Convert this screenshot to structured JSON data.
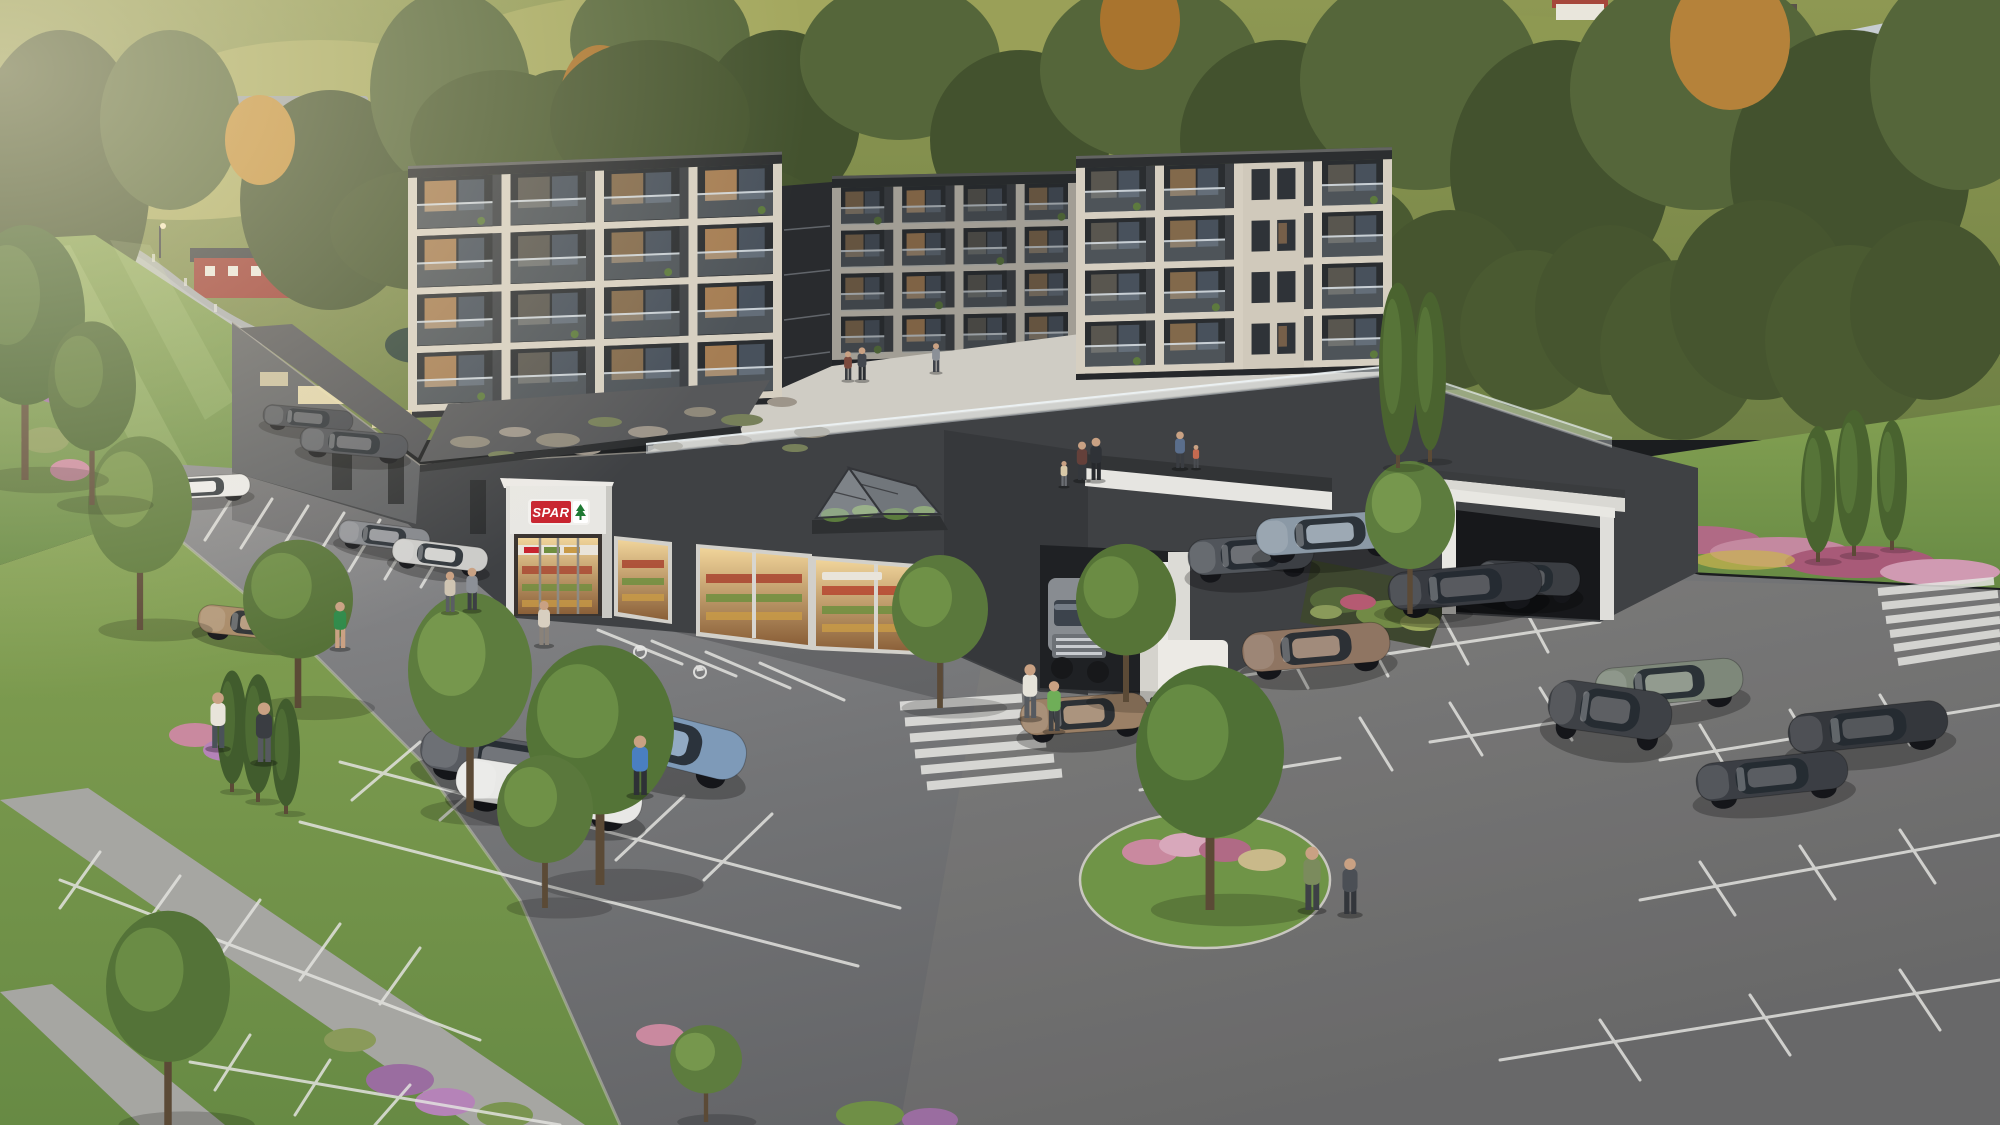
{
  "meta": {
    "title": "Aerial architectural rendering of a dark apartment complex with SPAR supermarket, rooftop courtyard terrace and large parking lot in a hillside village",
    "type": "3d-visualization",
    "width": 2000,
    "height": 1125
  },
  "signs": {
    "store_portal": "SPAR"
  },
  "palette": {
    "facade_dark": "#3d4044",
    "facade_shadow": "#36383b",
    "accent_cream": "#d6cfc1",
    "roof_dark": "#2c2e30",
    "terrace": "#cfccc4",
    "asphalt": "#77787a",
    "parking_line": "#e2e2de",
    "grass": "#6f9447",
    "tree_dark": "#567437",
    "tree_light": "#73984a",
    "autumn": "#b5823a",
    "spar_red": "#c8242f",
    "spar_green": "#1f7a34",
    "glass": "#8a97a6",
    "truck_white": "#e8e8e5"
  },
  "scene": {
    "wings": [
      {
        "id": "apartment-left-wing",
        "layer": "front",
        "x": 408,
        "y": 166,
        "w": 374,
        "h": 252,
        "floors": 4,
        "bays": 4,
        "skew": -2.2,
        "solid": [],
        "dim": 0,
        "seed": 0
      },
      {
        "id": "apartment-rear-wing",
        "layer": "rear",
        "x": 832,
        "y": 176,
        "w": 245,
        "h": 190,
        "floors": 4,
        "bays": 4,
        "skew": -1.2,
        "solid": [],
        "dim": 0.28,
        "seed": 1
      },
      {
        "id": "apartment-right-wing",
        "layer": "front",
        "x": 1076,
        "y": 156,
        "w": 316,
        "h": 224,
        "floors": 4,
        "bays": 4,
        "skew": -1.6,
        "solid": [
          2
        ],
        "dim": 0,
        "seed": 2
      }
    ],
    "gravel_patches": [
      {
        "x": 470,
        "y": 442,
        "rx": 20,
        "ry": 6,
        "c": "#8f897b"
      },
      {
        "x": 515,
        "y": 432,
        "rx": 16,
        "ry": 5,
        "c": "#9d958a"
      },
      {
        "x": 558,
        "y": 440,
        "rx": 22,
        "ry": 7,
        "c": "#8f897b"
      },
      {
        "x": 605,
        "y": 422,
        "rx": 17,
        "ry": 5,
        "c": "#77805a"
      },
      {
        "x": 648,
        "y": 432,
        "rx": 20,
        "ry": 6,
        "c": "#9d958a"
      },
      {
        "x": 700,
        "y": 412,
        "rx": 16,
        "ry": 5,
        "c": "#8f897b"
      },
      {
        "x": 742,
        "y": 420,
        "rx": 21,
        "ry": 6,
        "c": "#77805a"
      },
      {
        "x": 782,
        "y": 402,
        "rx": 15,
        "ry": 5,
        "c": "#9d958a"
      },
      {
        "x": 812,
        "y": 432,
        "rx": 18,
        "ry": 6,
        "c": "#8f897b"
      },
      {
        "x": 502,
        "y": 455,
        "rx": 14,
        "ry": 4,
        "c": "#77805a"
      },
      {
        "x": 585,
        "y": 450,
        "rx": 16,
        "ry": 5,
        "c": "#9d958a"
      },
      {
        "x": 668,
        "y": 446,
        "rx": 15,
        "ry": 5,
        "c": "#8f897b"
      },
      {
        "x": 735,
        "y": 440,
        "rx": 17,
        "ry": 5,
        "c": "#9d958a"
      },
      {
        "x": 795,
        "y": 448,
        "rx": 13,
        "ry": 4,
        "c": "#77805a"
      }
    ],
    "cars": [
      {
        "id": "car-white-sedan-rear",
        "x": 150,
        "y": 470,
        "w": 100,
        "h": 34,
        "a": -3,
        "c": "#e9e9e7"
      },
      {
        "id": "car-dark-sedan-1",
        "x": 263,
        "y": 402,
        "w": 90,
        "h": 32,
        "a": 5,
        "c": "#41444a"
      },
      {
        "id": "car-dark-sedan-2",
        "x": 300,
        "y": 424,
        "w": 108,
        "h": 38,
        "a": 5,
        "c": "#4a4d53"
      },
      {
        "id": "car-gray-sedan-store",
        "x": 338,
        "y": 518,
        "w": 92,
        "h": 36,
        "a": 7,
        "c": "#83868c"
      },
      {
        "id": "car-silver-sedan-store",
        "x": 392,
        "y": 536,
        "w": 96,
        "h": 38,
        "a": 7,
        "c": "#cbcbc9"
      },
      {
        "id": "car-graphite-sedan",
        "x": 420,
        "y": 728,
        "w": 180,
        "h": 64,
        "a": 9,
        "c": "#585b61"
      },
      {
        "id": "car-white-sedan-front",
        "x": 455,
        "y": 758,
        "w": 188,
        "h": 66,
        "a": 9,
        "c": "#e8e8e6"
      },
      {
        "id": "car-bronze-sedan-left",
        "x": 198,
        "y": 602,
        "w": 124,
        "h": 44,
        "a": 6,
        "c": "#a88a68"
      },
      {
        "id": "car-blue-estate",
        "x": 572,
        "y": 700,
        "w": 176,
        "h": 78,
        "a": 14,
        "c": "#7e9ab8"
      },
      {
        "id": "car-bronze-estate",
        "x": 1020,
        "y": 686,
        "w": 128,
        "h": 56,
        "a": -4,
        "c": "#9b8066"
      },
      {
        "id": "car-suv-garage",
        "x": 1476,
        "y": 552,
        "w": 104,
        "h": 52,
        "a": 2,
        "c": "#3b3e43"
      },
      {
        "id": "car-gray-suv",
        "x": 1188,
        "y": 526,
        "w": 126,
        "h": 56,
        "a": -4,
        "c": "#51555b"
      },
      {
        "id": "car-slate-suv",
        "x": 1256,
        "y": 504,
        "w": 148,
        "h": 58,
        "a": -4,
        "c": "#8b99a6"
      },
      {
        "id": "car-black-sedan",
        "x": 1388,
        "y": 556,
        "w": 154,
        "h": 60,
        "a": -5,
        "c": "#383b41"
      },
      {
        "id": "car-bronze-sedan-right",
        "x": 1242,
        "y": 616,
        "w": 148,
        "h": 62,
        "a": -5,
        "c": "#8f7562"
      },
      {
        "id": "car-sage-estate",
        "x": 1595,
        "y": 652,
        "w": 148,
        "h": 62,
        "a": -5,
        "c": "#7e887a"
      },
      {
        "id": "car-graphite-suv",
        "x": 1548,
        "y": 672,
        "w": 124,
        "h": 76,
        "a": 8,
        "c": "#3e4146"
      },
      {
        "id": "car-dark-sedan-3",
        "x": 1788,
        "y": 696,
        "w": 160,
        "h": 62,
        "a": -6,
        "c": "#34373c"
      },
      {
        "id": "car-dark-sedan-4",
        "x": 1696,
        "y": 746,
        "w": 152,
        "h": 60,
        "a": -6,
        "c": "#3b3e44"
      }
    ],
    "trees": [
      {
        "id": "tree",
        "x": 140,
        "y": 630,
        "h": 190,
        "r": 52,
        "c1": "#5d7a3c",
        "c2": "#79984c",
        "shape": "round"
      },
      {
        "id": "tree",
        "x": 298,
        "y": 708,
        "h": 165,
        "r": 55,
        "c1": "#567238",
        "c2": "#6f8f46",
        "shape": "round"
      },
      {
        "id": "tree",
        "x": 470,
        "y": 812,
        "h": 215,
        "r": 62,
        "c1": "#5d7c3e",
        "c2": "#7a9c50",
        "shape": "round"
      },
      {
        "id": "tree",
        "x": 600,
        "y": 885,
        "h": 235,
        "r": 74,
        "c1": "#547437",
        "c2": "#6f9248",
        "shape": "round"
      },
      {
        "id": "tree",
        "x": 940,
        "y": 708,
        "h": 150,
        "r": 48,
        "c1": "#5a783c",
        "c2": "#739549",
        "shape": "round"
      },
      {
        "id": "tree",
        "x": 1126,
        "y": 702,
        "h": 155,
        "r": 50,
        "c1": "#567437",
        "c2": "#6f9147",
        "shape": "round"
      },
      {
        "id": "tree-planting-bed",
        "x": 1410,
        "y": 614,
        "h": 150,
        "r": 45,
        "c1": "#5d7c3e",
        "c2": "#7a9c50",
        "shape": "round"
      },
      {
        "id": "tree-island",
        "x": 1210,
        "y": 910,
        "h": 240,
        "r": 74,
        "c1": "#4f7035",
        "c2": "#6a8f45",
        "shape": "round"
      },
      {
        "id": "tree",
        "x": 545,
        "y": 908,
        "h": 150,
        "r": 48,
        "c1": "#5a783c",
        "c2": "#739549",
        "shape": "round"
      },
      {
        "id": "tree",
        "x": 168,
        "y": 1125,
        "h": 210,
        "r": 62,
        "c1": "#547338",
        "c2": "#6e9048",
        "shape": "round"
      },
      {
        "id": "tree",
        "x": 706,
        "y": 1122,
        "h": 95,
        "r": 36,
        "c1": "#5d7c3e",
        "c2": "#7a9c50",
        "shape": "round"
      },
      {
        "id": "tree",
        "x": 25,
        "y": 480,
        "h": 250,
        "r": 60,
        "c1": "#43602e",
        "c2": "#567538",
        "shape": "round"
      },
      {
        "id": "tree",
        "x": 92,
        "y": 505,
        "h": 180,
        "r": 44,
        "c1": "#4a6531",
        "c2": "#5e7c3c",
        "shape": "round"
      },
      {
        "id": "conifer",
        "x": 232,
        "y": 792,
        "h": 118,
        "r": 15,
        "c1": "#415c2d",
        "c2": "#547338",
        "shape": "column"
      },
      {
        "id": "conifer",
        "x": 258,
        "y": 802,
        "h": 124,
        "r": 16,
        "c1": "#415c2d",
        "c2": "#547338",
        "shape": "column"
      },
      {
        "id": "conifer",
        "x": 286,
        "y": 814,
        "h": 112,
        "r": 14,
        "c1": "#415c2d",
        "c2": "#547338",
        "shape": "column"
      },
      {
        "id": "poplar",
        "x": 1398,
        "y": 468,
        "h": 180,
        "r": 19,
        "c1": "#4a632f",
        "c2": "#5d7c3c",
        "shape": "column"
      },
      {
        "id": "poplar",
        "x": 1430,
        "y": 462,
        "h": 165,
        "r": 16,
        "c1": "#4a632f",
        "c2": "#5d7c3c",
        "shape": "column"
      },
      {
        "id": "poplar",
        "x": 1818,
        "y": 562,
        "h": 132,
        "r": 17,
        "c1": "#49632f",
        "c2": "#5d7c3c",
        "shape": "column"
      },
      {
        "id": "poplar",
        "x": 1854,
        "y": 556,
        "h": 142,
        "r": 18,
        "c1": "#49632f",
        "c2": "#5d7c3c",
        "shape": "column"
      },
      {
        "id": "poplar",
        "x": 1892,
        "y": 550,
        "h": 126,
        "r": 15,
        "c1": "#49632f",
        "c2": "#5d7c3c",
        "shape": "column"
      }
    ],
    "people": [
      {
        "id": "person-plaza",
        "x": 848,
        "y": 380,
        "h": 30,
        "c1": "#7c4a3e",
        "c2": "#3a3d42"
      },
      {
        "id": "person-plaza",
        "x": 862,
        "y": 380,
        "h": 34,
        "c1": "#43474e",
        "c2": "#2b2e32"
      },
      {
        "id": "person-plaza",
        "x": 936,
        "y": 372,
        "h": 30,
        "c1": "#8b9097",
        "c2": "#40434a"
      },
      {
        "id": "person-courtyard",
        "x": 1082,
        "y": 480,
        "h": 40,
        "c1": "#64403a",
        "c2": "#34373c"
      },
      {
        "id": "person-courtyard",
        "x": 1096,
        "y": 480,
        "h": 44,
        "c1": "#2f3237",
        "c2": "#26282c"
      },
      {
        "id": "person-courtyard-child",
        "x": 1064,
        "y": 486,
        "h": 26,
        "c1": "#d9c9a8",
        "c2": "#6b6e73"
      },
      {
        "id": "person-courtyard",
        "x": 1180,
        "y": 468,
        "h": 38,
        "c1": "#5a6e8c",
        "c2": "#3a3d42"
      },
      {
        "id": "person-courtyard-child",
        "x": 1196,
        "y": 468,
        "h": 24,
        "c1": "#c46a50",
        "c2": "#4a4d52"
      },
      {
        "id": "person-store",
        "x": 450,
        "y": 612,
        "h": 42,
        "c1": "#cfc4b2",
        "c2": "#5a5d63"
      },
      {
        "id": "person-store",
        "x": 472,
        "y": 610,
        "h": 44,
        "c1": "#8c9097",
        "c2": "#3c3f44"
      },
      {
        "id": "person-green-dress",
        "x": 340,
        "y": 648,
        "h": 48,
        "c1": "#2f8a4a",
        "c2": "#caa183"
      },
      {
        "id": "person-store",
        "x": 544,
        "y": 645,
        "h": 46,
        "c1": "#d8cfc0",
        "c2": "#8a8279"
      },
      {
        "id": "person-blue-jacket",
        "x": 640,
        "y": 795,
        "h": 62,
        "c1": "#4a7fc1",
        "c2": "#2e3136"
      },
      {
        "id": "person-path",
        "x": 218,
        "y": 748,
        "h": 58,
        "c1": "#e8e4da",
        "c2": "#4a5258"
      },
      {
        "id": "person-path",
        "x": 264,
        "y": 762,
        "h": 62,
        "c1": "#3a3d42",
        "c2": "#56595f"
      },
      {
        "id": "person-lot",
        "x": 1030,
        "y": 718,
        "h": 56,
        "c1": "#e6e3d9",
        "c2": "#565a60"
      },
      {
        "id": "person-lot-child",
        "x": 1054,
        "y": 731,
        "h": 52,
        "c1": "#6fae58",
        "c2": "#3f4246"
      },
      {
        "id": "person-crosswalk",
        "x": 1312,
        "y": 910,
        "h": 66,
        "c1": "#7b8b5d",
        "c2": "#3e4146"
      },
      {
        "id": "person-crosswalk",
        "x": 1350,
        "y": 914,
        "h": 58,
        "c1": "#4b4f55",
        "c2": "#33363b"
      }
    ]
  }
}
